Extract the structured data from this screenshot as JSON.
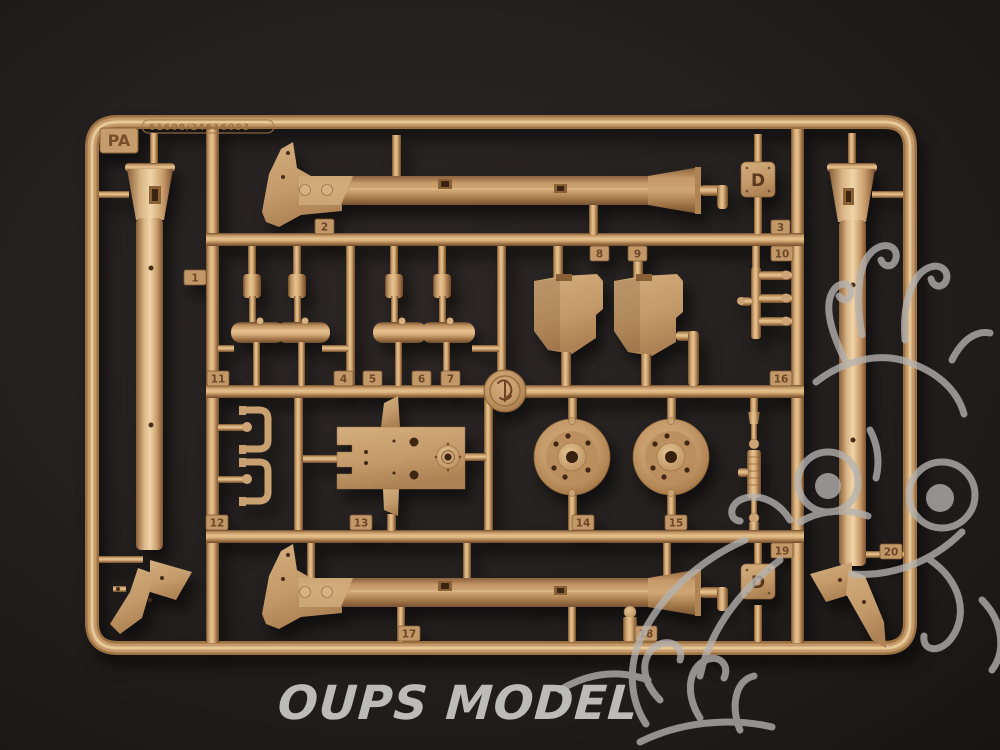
{
  "photo": {
    "subject": "tan plastic model kit sprue photographed on dark background",
    "background_color": "#242020",
    "plastic_color": "#c89e6e"
  },
  "sprue": {
    "corner_letter": "PA",
    "mold_number": "61608/24616093",
    "d_mark": "D",
    "part_tabs": [
      {
        "label": "1"
      },
      {
        "label": "2"
      },
      {
        "label": "3"
      },
      {
        "label": "4"
      },
      {
        "label": "5"
      },
      {
        "label": "6"
      },
      {
        "label": "7"
      },
      {
        "label": "8"
      },
      {
        "label": "9"
      },
      {
        "label": "10"
      },
      {
        "label": "11"
      },
      {
        "label": "12"
      },
      {
        "label": "13"
      },
      {
        "label": "14"
      },
      {
        "label": "15"
      },
      {
        "label": "16"
      },
      {
        "label": "17"
      },
      {
        "label": "18"
      },
      {
        "label": "19"
      },
      {
        "label": "20"
      }
    ]
  },
  "watermarks": {
    "brand_text": "OUPS MODEL",
    "brand_color": "#bdbbb9",
    "dragon_motif": "dragon-head-outline",
    "dragon_color": "#b5b3b1"
  }
}
